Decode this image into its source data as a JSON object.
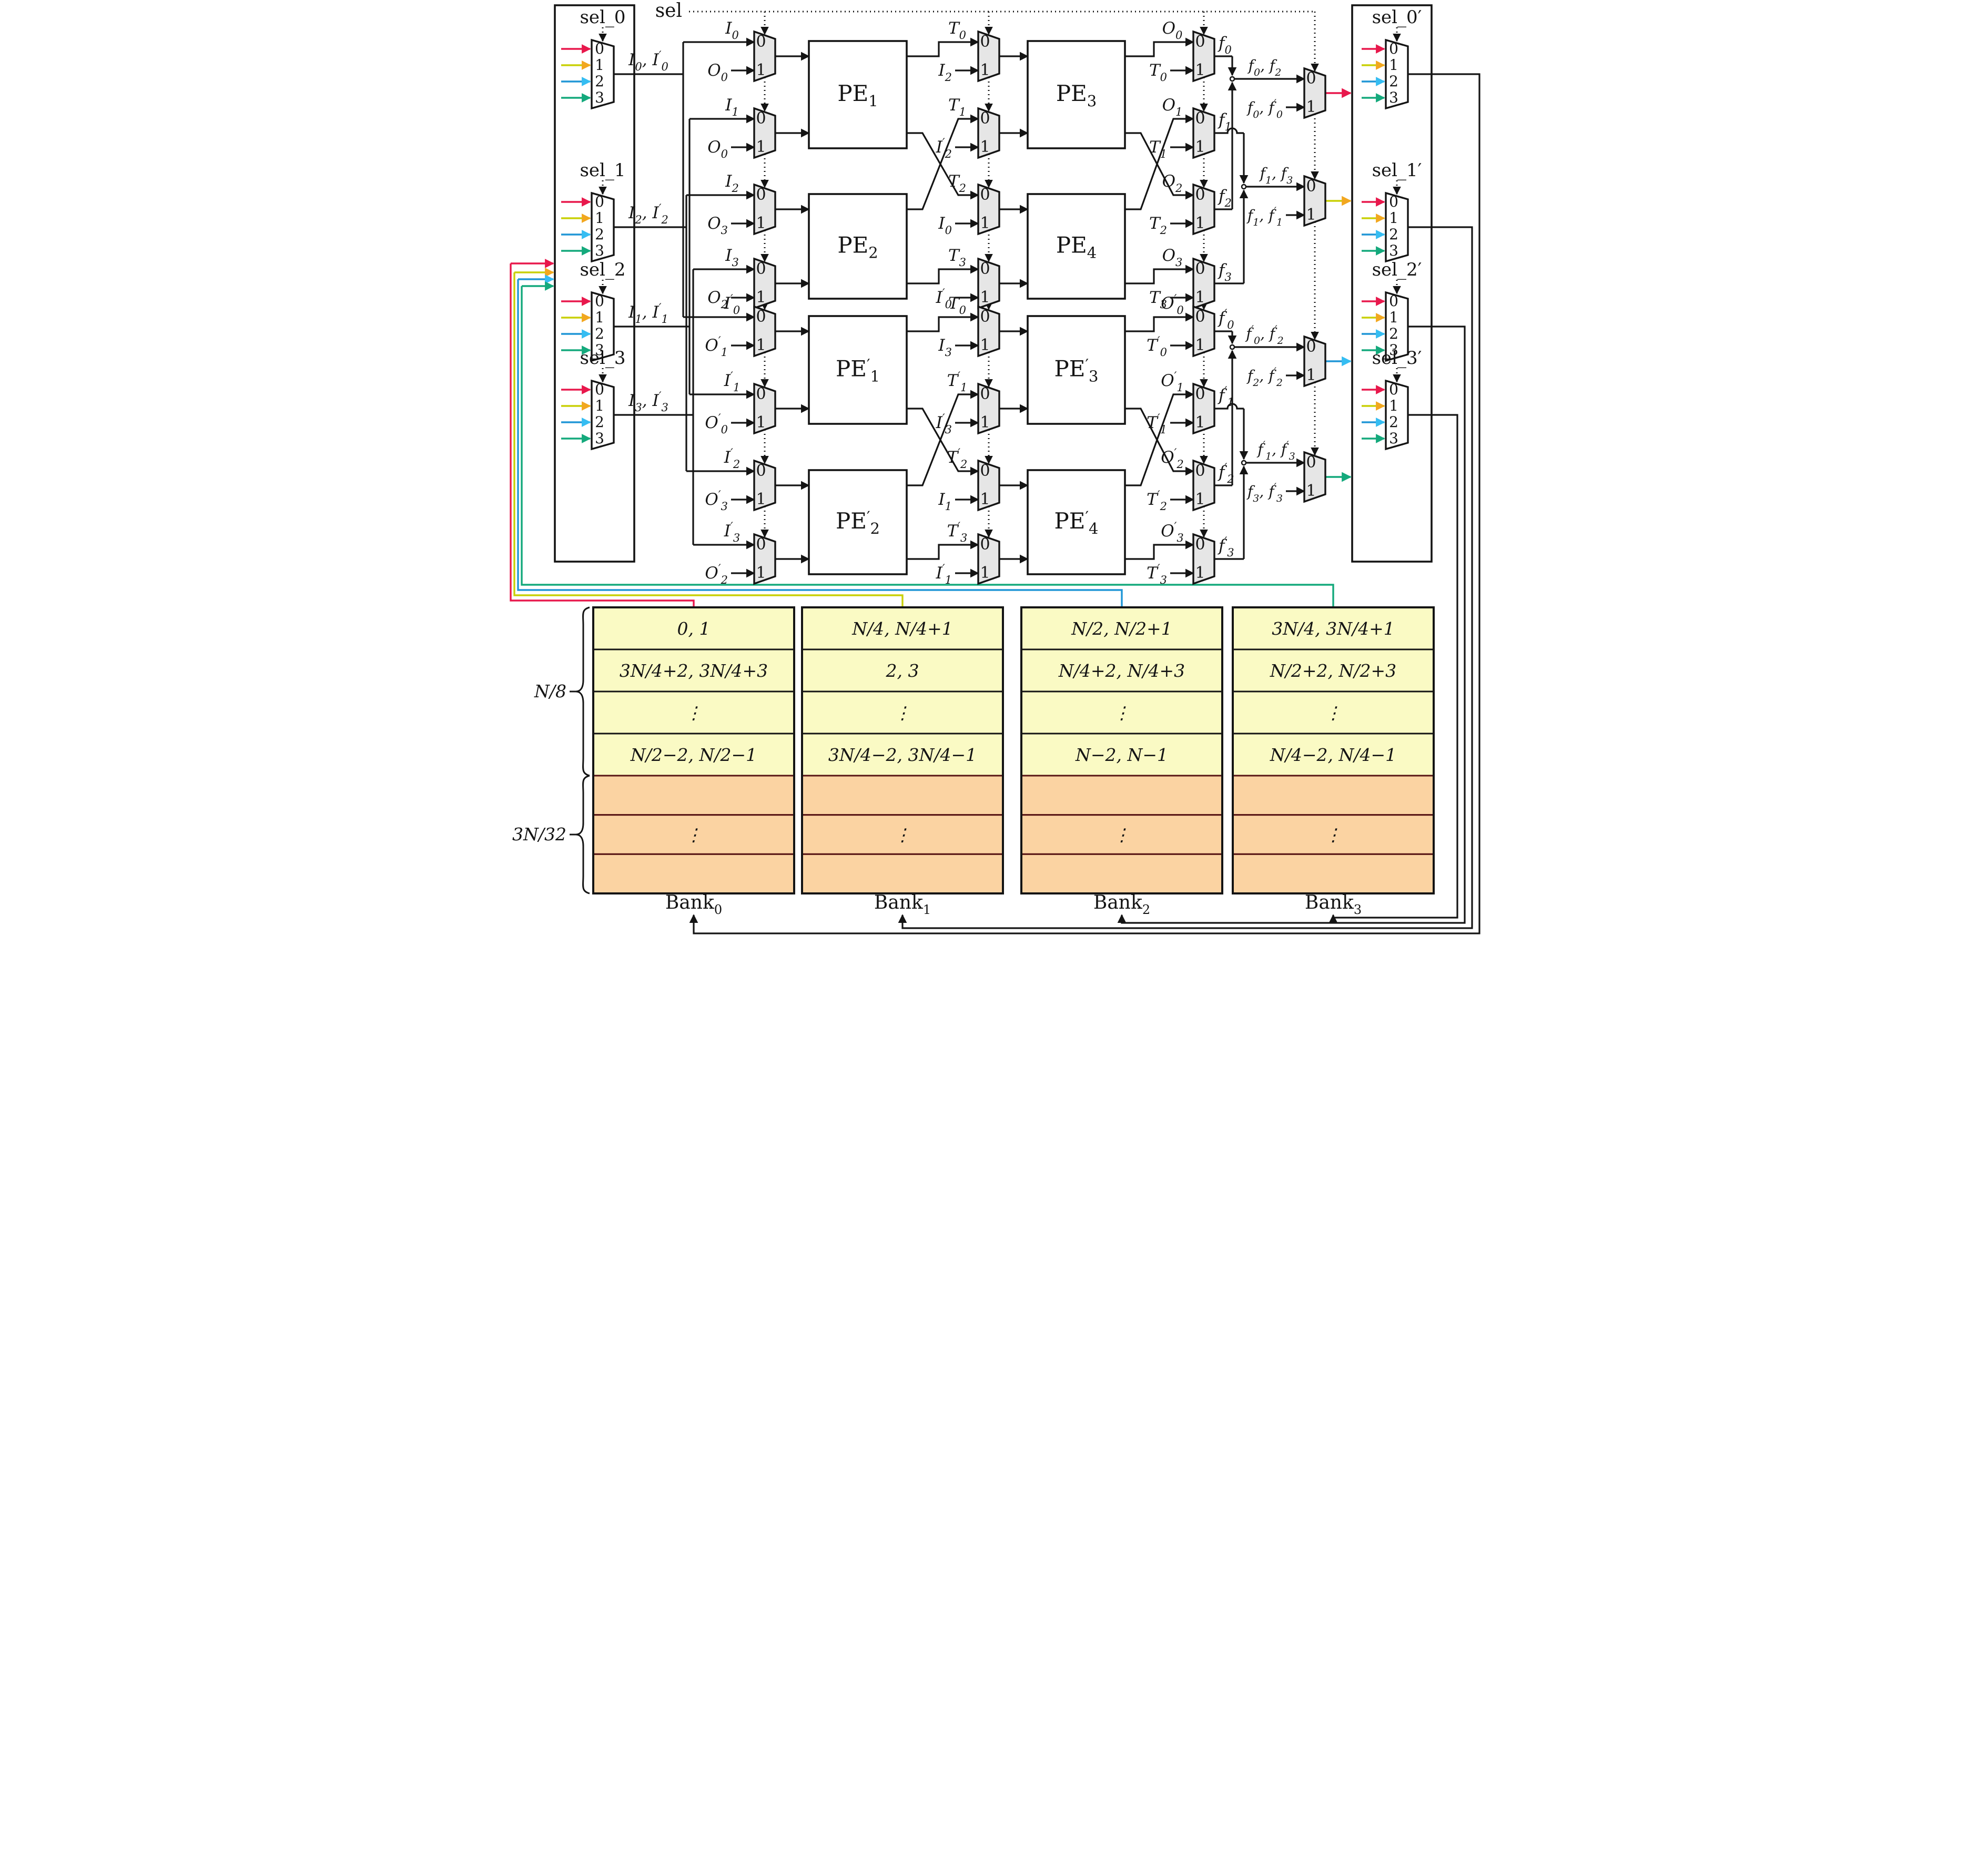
{
  "diagram": {
    "sel_label": "sel",
    "left_selectors": [
      {
        "label": "sel_0",
        "output": "I_0, I_0'"
      },
      {
        "label": "sel_1",
        "output": "I_2, I_2'"
      },
      {
        "label": "sel_2",
        "output": "I_1, I_1'"
      },
      {
        "label": "sel_3",
        "output": "I_3, I_3'"
      }
    ],
    "right_selectors": [
      {
        "label": "sel_0'"
      },
      {
        "label": "sel_1'"
      },
      {
        "label": "sel_2'"
      },
      {
        "label": "sel_3'"
      }
    ],
    "mux2_ports": [
      "0",
      "1"
    ],
    "mux4_ports": [
      "0",
      "1",
      "2",
      "3"
    ],
    "rows": [
      {
        "input": "I_0",
        "input_alt": "O_0",
        "mid": "T_0",
        "mid_alt": "I_2",
        "out": "O_0",
        "out_alt": "T_0",
        "f": "f_0"
      },
      {
        "input": "I_1",
        "input_alt": "O_0",
        "mid": "T_1",
        "mid_alt": "I_2'",
        "out": "O_1",
        "out_alt": "T_1",
        "f": "f_1"
      },
      {
        "input": "I_2",
        "input_alt": "O_3",
        "mid": "T_2",
        "mid_alt": "I_0",
        "out": "O_2",
        "out_alt": "T_2",
        "f": "f_2"
      },
      {
        "input": "I_3",
        "input_alt": "O_2",
        "mid": "T_3",
        "mid_alt": "I_0'",
        "out": "O_3",
        "out_alt": "T_3",
        "f": "f_3"
      },
      {
        "input": "I_0'",
        "input_alt": "O_1'",
        "mid": "T_0",
        "mid_alt": "I_3",
        "out": "O_0'",
        "out_alt": "T_0'",
        "f": "f_0'"
      },
      {
        "input": "I_1'",
        "input_alt": "O_0'",
        "mid": "T_1'",
        "mid_alt": "I_3'",
        "out": "O_1'",
        "out_alt": "T_1'",
        "f": "f_1'"
      },
      {
        "input": "I_2'",
        "input_alt": "O_3'",
        "mid": "T_2'",
        "mid_alt": "I_1",
        "out": "O_2'",
        "out_alt": "T_2'",
        "f": "f_2'"
      },
      {
        "input": "I_3'",
        "input_alt": "O_2'",
        "mid": "T_3'",
        "mid_alt": "I_1'",
        "out": "O_3'",
        "out_alt": "T_3'",
        "f": "f_3'"
      }
    ],
    "pes": [
      "PE_1",
      "PE_2",
      "PE_3",
      "PE_4",
      "PE_1'",
      "PE_2'",
      "PE_3'",
      "PE_4'"
    ],
    "final_muxes": [
      {
        "in0": "f_0, f_2",
        "in1": "f_0, f_0'",
        "color": "red"
      },
      {
        "in0": "f_1, f_3",
        "in1": "f_1, f_1'",
        "color": "yellow"
      },
      {
        "in0": "f_0', f_2'",
        "in1": "f_2, f_2'",
        "color": "blue"
      },
      {
        "in0": "f_1', f_3'",
        "in1": "f_3, f_3'",
        "color": "green"
      }
    ],
    "banks": [
      {
        "name": "Bank_0",
        "rows": [
          "0, 1",
          "3N/4+2, 3N/4+3",
          "⋮",
          "N/2−2, N/2−1"
        ]
      },
      {
        "name": "Bank_1",
        "rows": [
          "N/4, N/4+1",
          "2, 3",
          "⋮",
          "3N/4−2, 3N/4−1"
        ]
      },
      {
        "name": "Bank_2",
        "rows": [
          "N/2, N/2+1",
          "N/4+2, N/4+3",
          "⋮",
          "N−2, N−1"
        ]
      },
      {
        "name": "Bank_3",
        "rows": [
          "3N/4, 3N/4+1",
          "N/2+2, N/2+3",
          "⋮",
          "N/4−2, N/4−1"
        ]
      }
    ],
    "bank_spare_rows": [
      "",
      "⋮",
      ""
    ],
    "braces": {
      "upper": "N/8",
      "lower": "3N/32"
    },
    "colors": {
      "red": "#e8184c",
      "yellow": "#c9d006",
      "yellow_head": "#f2a71f",
      "blue": "#2096d6",
      "blue_head": "#35bdf2",
      "green": "#14a97c",
      "bank_yellow": "#fafac4",
      "bank_orange": "#fbd3a2",
      "bank_orange_line": "#571414",
      "pe_fill": "#e6e6e6",
      "mux_fill": "#e6e6e6",
      "ink": "#141414"
    }
  }
}
